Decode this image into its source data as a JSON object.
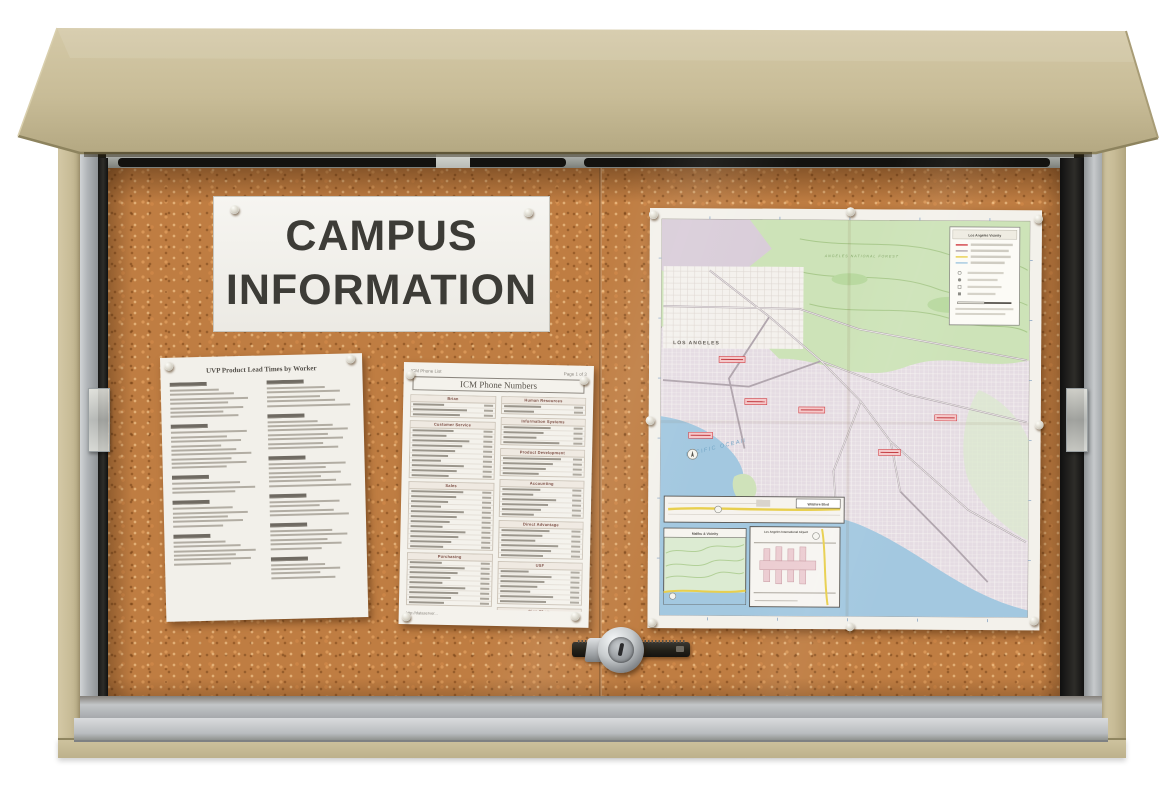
{
  "photo": {
    "subject": "Tan outdoor enclosed cork bulletin board cabinet with sliding glass doors, keyed lock, and posted campus information"
  },
  "sign": {
    "line1": "CAMPUS",
    "line2": "INFORMATION"
  },
  "doc_lead_times": {
    "title": "UVP Product Lead Times by Worker",
    "columns": [
      [
        7,
        9,
        3,
        5,
        6
      ],
      [
        5,
        7,
        6,
        4,
        5,
        4
      ]
    ]
  },
  "doc_phone": {
    "header_left": "ICM Phone List",
    "header_right": "Page 1 of 3",
    "title": "ICM Phone Numbers",
    "columns": {
      "left": [
        {
          "name": "Brian",
          "rows": 3
        },
        {
          "name": "Customer Service",
          "rows": 10
        },
        {
          "name": "Sales",
          "rows": 12
        },
        {
          "name": "Purchasing",
          "rows": 9
        },
        {
          "name": "Warehouse",
          "rows": 11
        }
      ],
      "right": [
        {
          "name": "Human Resources",
          "rows": 2
        },
        {
          "name": "Information Systems",
          "rows": 4
        },
        {
          "name": "Product Development",
          "rows": 4
        },
        {
          "name": "Accounting",
          "rows": 6
        },
        {
          "name": "Direct Advantage",
          "rows": 6
        },
        {
          "name": "USF",
          "rows": 7
        },
        {
          "name": "Sign Shop",
          "rows": 4
        },
        {
          "name": "Extra Extensions",
          "rows": 3
        }
      ]
    },
    "footer_url": "http://dataserver..."
  },
  "map": {
    "legend_title": "Los Angeles Vicinity",
    "labels": {
      "city": "LOS ANGELES",
      "ocean": "PACIFIC OCEAN",
      "forest": "ANGELES NATIONAL FOREST"
    },
    "insets": [
      {
        "label": "Wilshire Blvd"
      },
      {
        "label": "Malibu & Vicinity"
      },
      {
        "label": "Los Angeles International Airport"
      }
    ]
  },
  "colors": {
    "cabinet_tan": "#c9bd99",
    "cork": "#bf7d42",
    "aluminum": "#b7babd",
    "track_dark": "#211f1c",
    "map_ocean": "#a3c8e0",
    "map_forest": "#cfe5ba",
    "map_urban": "#e6dde4",
    "highlight_red": "#d24046"
  }
}
